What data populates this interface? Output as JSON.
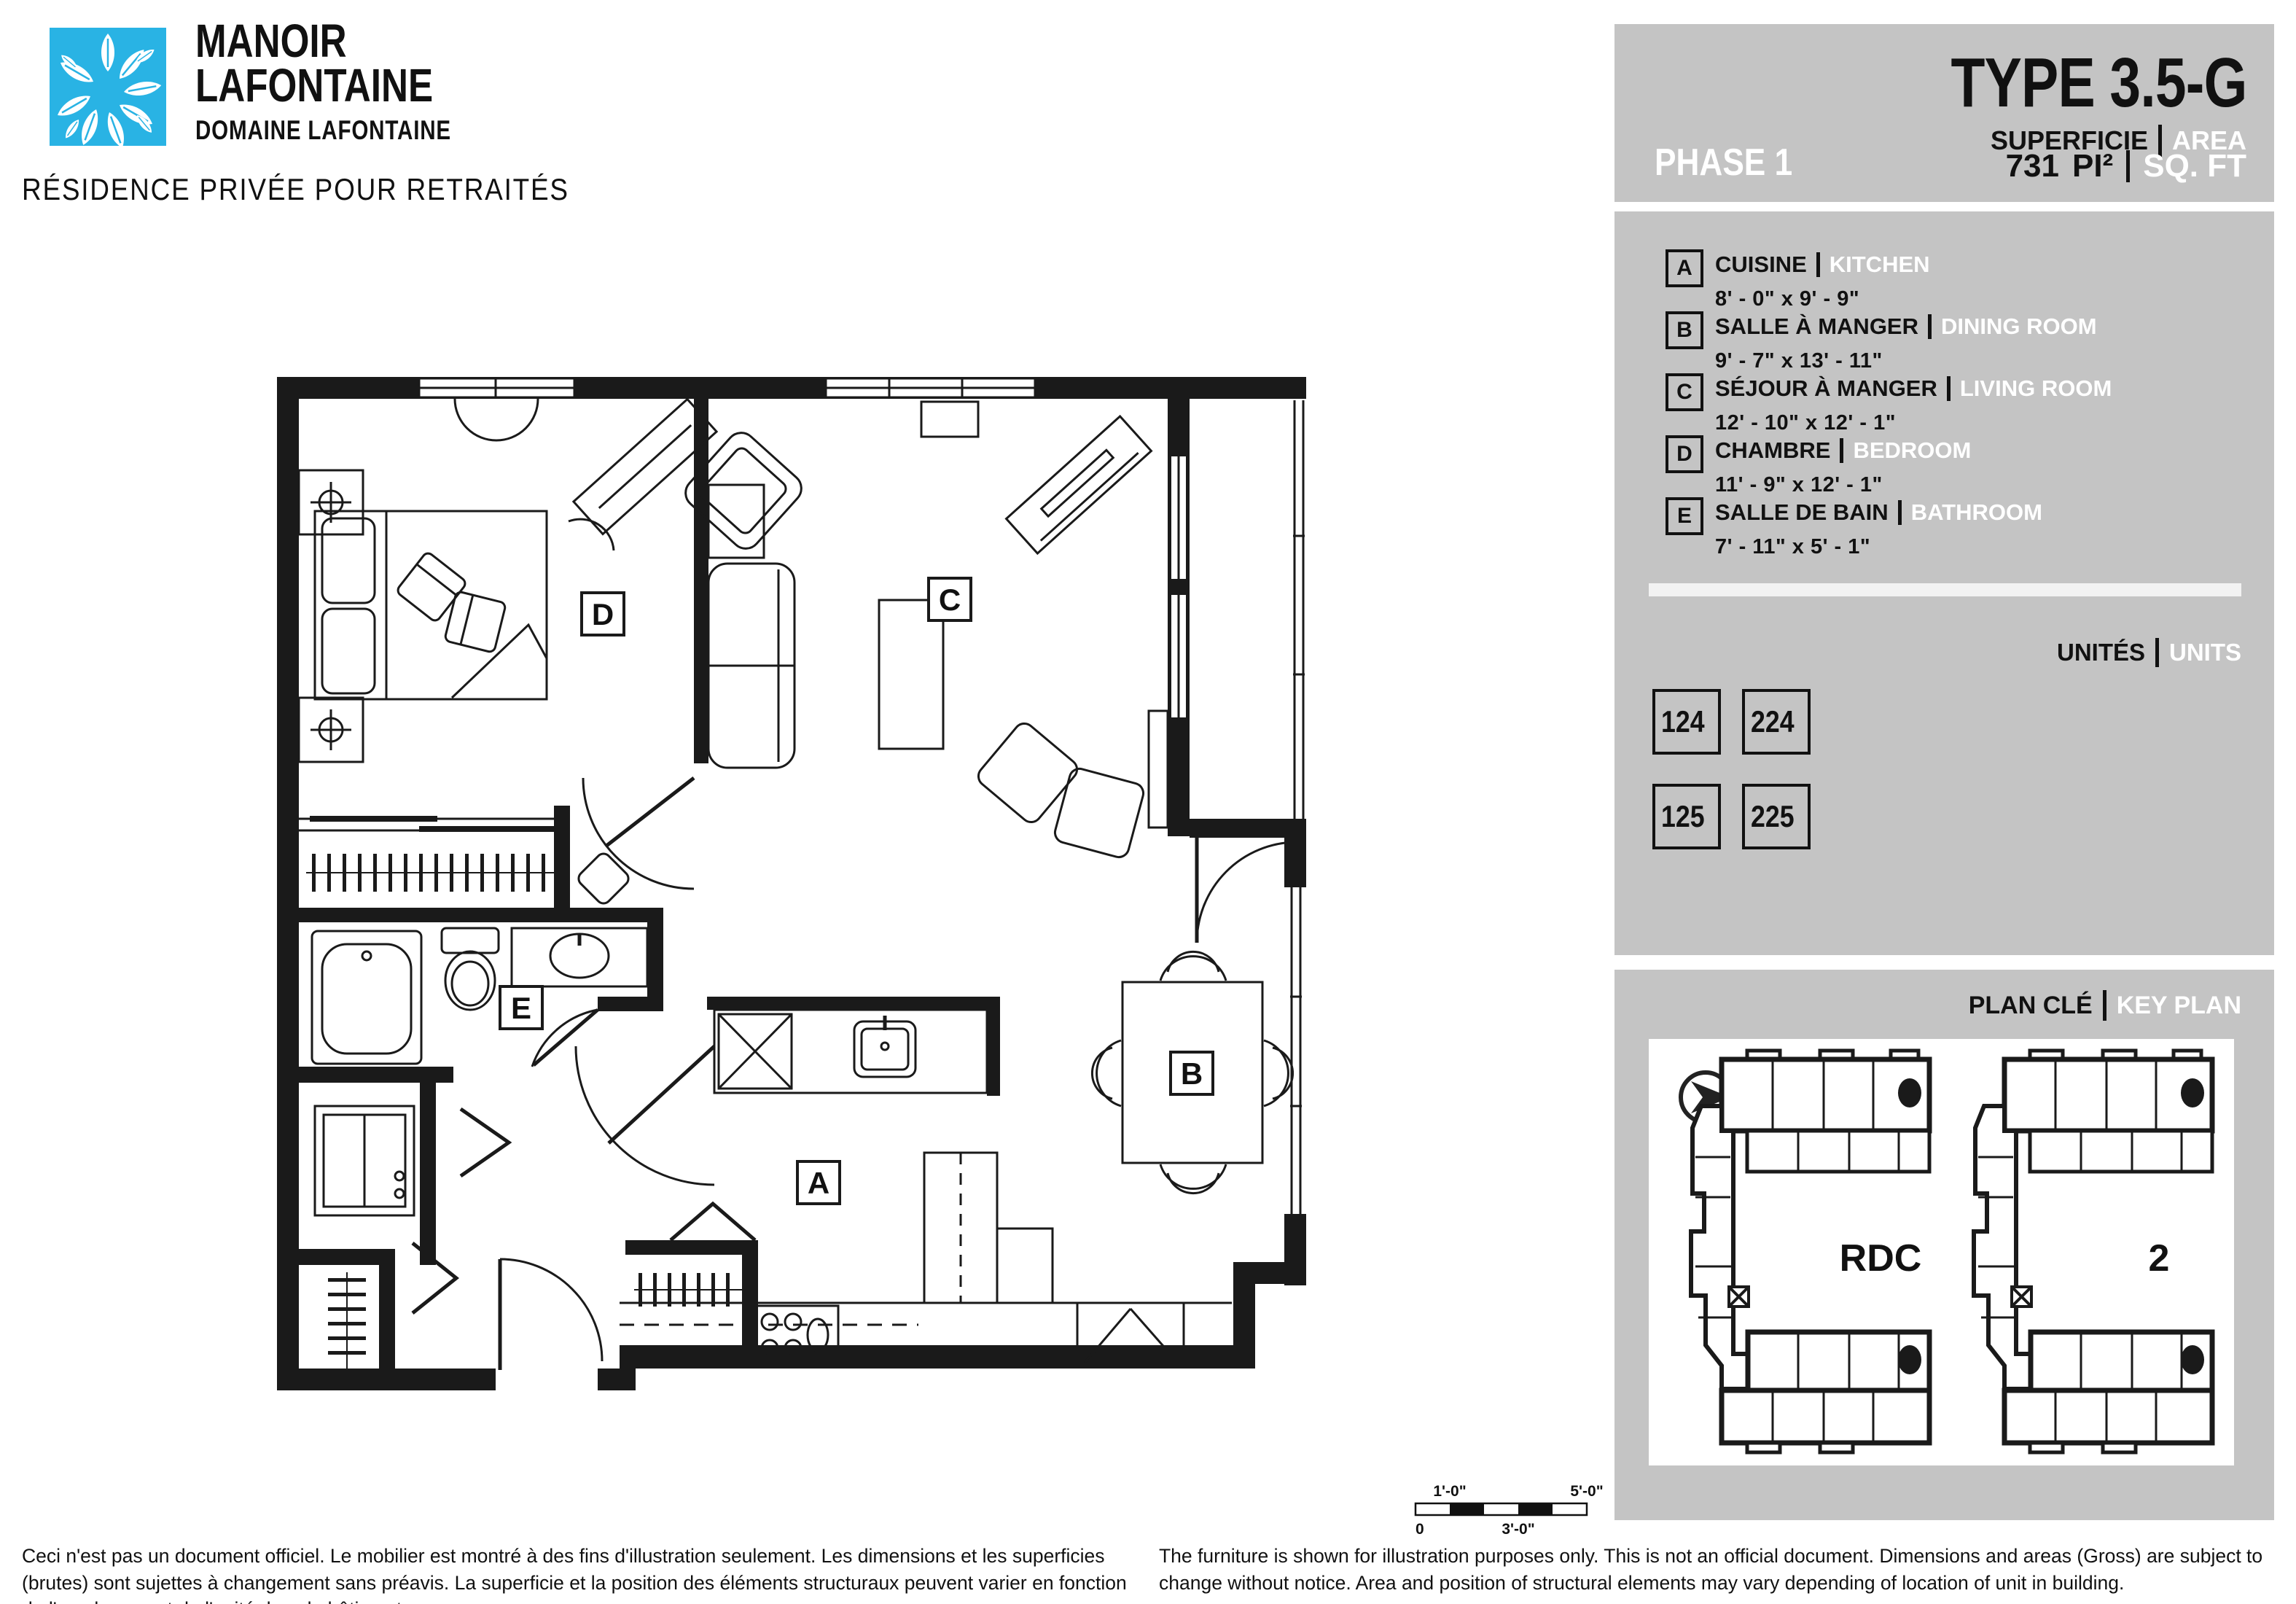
{
  "brand": {
    "name_line1": "MANOIR",
    "name_line2": "LAFONTAINE",
    "subtitle": "DOMAINE LAFONTAINE",
    "tagline": "RÉSIDENCE PRIVÉE POUR RETRAITÉS",
    "logo_color": "#29b3e4"
  },
  "header": {
    "unit_type": "TYPE 3.5-G",
    "superficie_label": "SUPERFICIE",
    "area_label": "AREA",
    "phase": "PHASE 1",
    "area_value": "731",
    "area_unit_fr": "PI²",
    "area_unit_en": "SQ. FT"
  },
  "legend": {
    "rooms": [
      {
        "letter": "A",
        "name_fr": "CUISINE",
        "name_en": "KITCHEN",
        "dims": "8' - 0\" x 9' - 9\""
      },
      {
        "letter": "B",
        "name_fr": "SALLE À MANGER",
        "name_en": "DINING ROOM",
        "dims": "9' - 7\" x 13' - 11\""
      },
      {
        "letter": "C",
        "name_fr": "SÉJOUR À MANGER",
        "name_en": "LIVING ROOM",
        "dims": "12' - 10\" x 12' - 1\""
      },
      {
        "letter": "D",
        "name_fr": "CHAMBRE",
        "name_en": "BEDROOM",
        "dims": "11' - 9\" x 12' - 1\""
      },
      {
        "letter": "E",
        "name_fr": "SALLE DE BAIN",
        "name_en": "BATHROOM",
        "dims": "7' -  11\" x 5' - 1\""
      }
    ]
  },
  "units": {
    "label_fr": "UNITÉS",
    "label_en": "UNITS",
    "numbers": [
      "124",
      "224",
      "125",
      "225"
    ]
  },
  "key_plan": {
    "label_fr": "PLAN CLÉ",
    "label_en": "KEY PLAN",
    "north_letter": "N",
    "floors": [
      {
        "label": "RDC"
      },
      {
        "label": "2"
      }
    ]
  },
  "plan": {
    "labels": {
      "a": "A",
      "b": "B",
      "c": "C",
      "d": "D",
      "e": "E"
    }
  },
  "scale_bar": {
    "top_left": "1'-0\"",
    "top_right": "5'-0\"",
    "bottom_left": "0",
    "bottom_mid": "3'-0\""
  },
  "disclaimer": {
    "fr": "Ceci n'est pas un document officiel. Le mobilier est montré à des fins d'illustration seulement. Les dimensions et les superficies (brutes) sont sujettes à changement sans préavis. La superficie et la position des éléments structuraux peuvent varier en fonction de l'emplacement de l'unité dans le bâtiment.",
    "en": "The furniture is shown for illustration purposes only. This is not an official document. Dimensions and areas (Gross) are subject to change without notice. Area and position of structural elements may vary depending of location of unit in building."
  },
  "colors": {
    "panel_gray": "#c4c4c4",
    "divider": "#f2f2f2",
    "ink": "#1a1a1a",
    "accent_blue": "#29b3e4"
  }
}
